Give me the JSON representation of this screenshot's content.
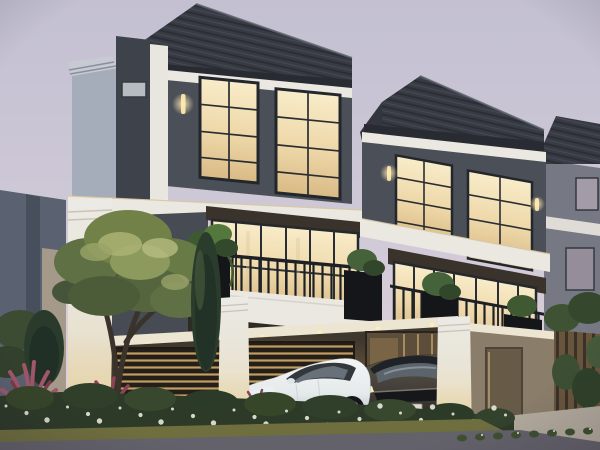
{
  "scene": {
    "description": "Dusk architectural rendering of a row of modern-classic three-storey townhouses with warm lit interiors, landscaped front garden and two sedans parked under the carport",
    "time_of_day": "dusk",
    "units_visible": 3,
    "vehicles": [
      {
        "type": "sedan",
        "color_name": "white",
        "position": "front carport, angled toward street"
      },
      {
        "type": "sedan",
        "color_name": "dark grey",
        "position": "behind white sedan, facing street"
      }
    ]
  },
  "palette": {
    "sky_top": "#c3c0d2",
    "sky_mid": "#cfc9d7",
    "sky_bottom": "#e4d8dc",
    "roof_dark": "#383b43",
    "roof_fascia": "#282b31",
    "wall_charcoal": "#4b0f58-FIXED",
    "wall_charcoal_fix": "#4b4f58",
    "wall_fin_dark": "#3e424b",
    "wall_blue_grey": "#a5adba",
    "trim_white": "#ebe8e1",
    "ceiling_white": "#ece5d2",
    "window_frame": "#23262b",
    "window_glow": "#f3dfae",
    "canopy_dark": "#3a332b",
    "railing_black": "#1d2024",
    "planter_black": "#141619",
    "carport_interior": "#3f382e",
    "carport_wall_beige": "#8a7d6a",
    "slat_warm": "#c29e62",
    "column_white": "#eceae5",
    "door_wood": "#675b48",
    "fence_wood": "#68553c",
    "tree_light": "#a8b173",
    "tree_mid": "#728148",
    "tree_dark": "#4c5c39",
    "cypress_green": "#2a3c2c",
    "cordyline_red": "#a0566b",
    "hedge_green": "#2d3a28",
    "flower_white": "#eae8dc",
    "tuft_green": "#3e5030",
    "grass_olive": "#6e6e3f",
    "road_grey": "#63616a",
    "paver_grey": "#514e57",
    "apron_concrete": "#b3aa9d",
    "car_white": "#e9edee",
    "car_dark": "#46413a",
    "headlight_warm": "#ffedc2",
    "bg_building": "#5a6170",
    "sconce_glow": "#ffe9b8"
  },
  "objects": {
    "sky": "pale lavender-pink dusk sky",
    "unit1": "front townhouse: dark hip roof, charcoal upper floor, white trim bands, balcony with black railing and planters, lit carport",
    "unit2": "middle townhouse, identical design, receding to the right",
    "unit3": "far townhouse, partially visible at right edge",
    "tree": "olive-green ornamental tree in front garden",
    "cypresses": "dark green columnar conifers",
    "cordylines": "red-purple cordyline shrubs at lower left",
    "hedge": "low hedge with small white flowers along the street edge",
    "white_sedan": "white compact sedan parked in the carport",
    "dark_sedan": "dark grey sedan parked beside it",
    "road": "asphalt street across the foreground"
  }
}
